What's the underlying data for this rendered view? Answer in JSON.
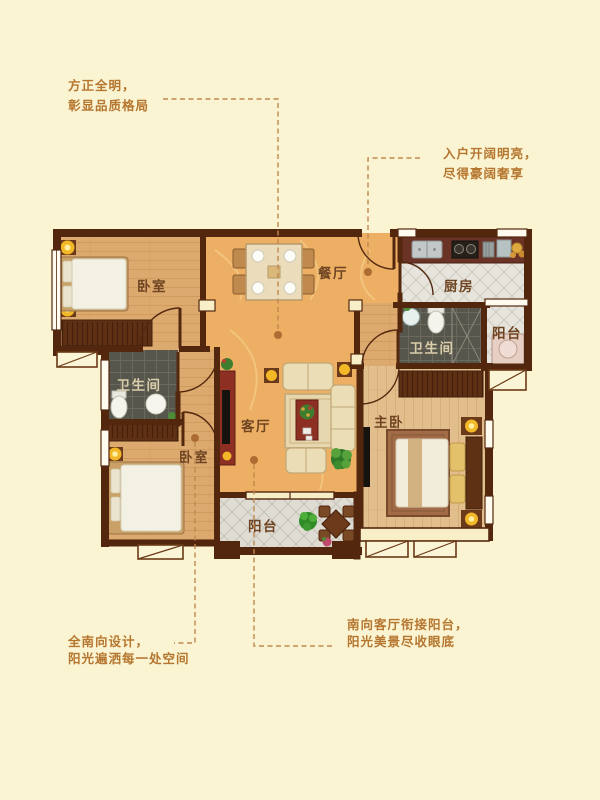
{
  "annotations": {
    "top_left": {
      "line1": "方正全明，",
      "line2": "彰显品质格局"
    },
    "top_right": {
      "line1": "入户开阔明亮，",
      "line2": "尽得豪阔奢享"
    },
    "bottom_left": {
      "line1": "全南向设计，",
      "line2": "阳光遍洒每一处空间"
    },
    "bottom_right": {
      "line1": "南向客厅衔接阳台，",
      "line2": "阳光美景尽收眼底"
    }
  },
  "rooms": {
    "bedroom_top": "卧室",
    "dining": "餐厅",
    "kitchen": "厨房",
    "bathroom_right": "卫生间",
    "balcony_right": "阳台",
    "bathroom_left": "卫生间",
    "living": "客厅",
    "bedroom_bottom": "卧室",
    "master_bedroom": "主卧",
    "balcony_bottom": "阳台"
  },
  "colors": {
    "background": "#FAF4D2",
    "annotation_text": "#B5762F",
    "leader_line": "#C08850",
    "room_label": "#6E4422",
    "room_label_on_dark": "#D9CCAA",
    "wall": "#53270E",
    "wood_floor": "#DCA96E",
    "master_wood_floor": "#E2BE8D",
    "marble_floor": "#ECAF64",
    "tile_light": "#E6E4DC",
    "tile_grey": "#DFDCD3",
    "tile_dark": "#57564C",
    "lamp_accent": "#F2B827",
    "red_furniture": "#8E2F23"
  }
}
